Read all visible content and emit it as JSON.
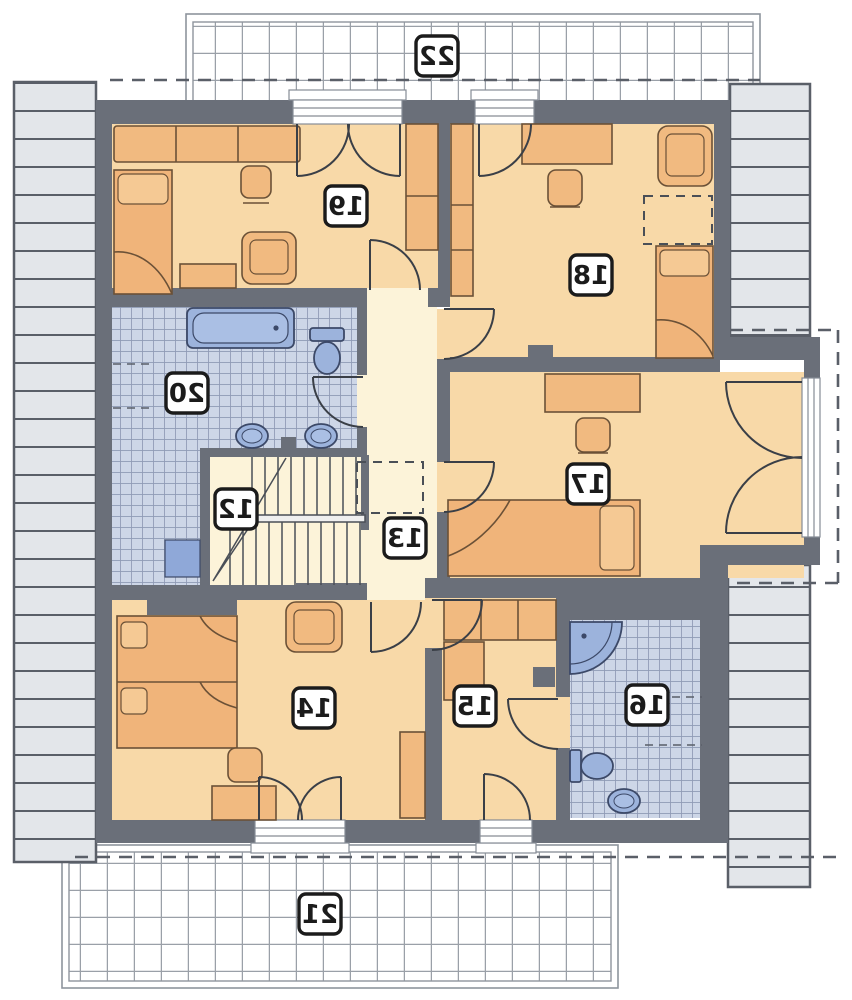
{
  "plan": {
    "kind": "attic-floor-plan",
    "mirrored_labels": true,
    "rooms": {
      "r12": {
        "label": "12",
        "type": "staircase"
      },
      "r13": {
        "label": "13",
        "type": "hallway"
      },
      "r14": {
        "label": "14",
        "type": "bedroom"
      },
      "r15": {
        "label": "15",
        "type": "wardrobe-room"
      },
      "r16": {
        "label": "16",
        "type": "bathroom"
      },
      "r17": {
        "label": "17",
        "type": "bedroom"
      },
      "r18": {
        "label": "18",
        "type": "bedroom"
      },
      "r19": {
        "label": "19",
        "type": "bedroom"
      },
      "r20": {
        "label": "20",
        "type": "bathroom"
      },
      "r21": {
        "label": "21",
        "type": "terrace"
      },
      "r22": {
        "label": "22",
        "type": "terrace"
      }
    }
  },
  "colors": {
    "wall": "#6a6f79",
    "room_floor": "#f8d9a8",
    "hall_floor": "#fcf3d9",
    "tile": "#cdd6e7",
    "tile_line": "#8f9ab5",
    "fixture_blue": "#9cb3dc",
    "furniture": "#f1ba80",
    "roof": "#e3e6ea",
    "terrace_grid_line": "#9aa0a8",
    "badge_border": "#1b1b1b"
  }
}
